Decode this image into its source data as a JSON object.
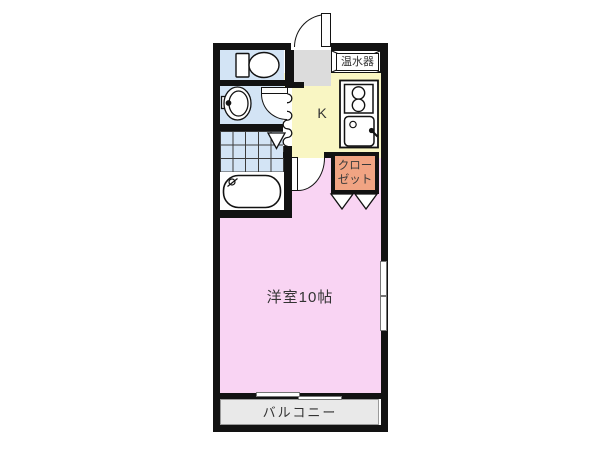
{
  "floorplan": {
    "title": "1K apartment floor plan",
    "labels": {
      "water_heater": "温水器",
      "kitchen": "K",
      "closet": "クロー\nゼット",
      "main_room": "洋室10帖",
      "balcony": "バルコニー"
    },
    "rooms": [
      {
        "name": "toilet",
        "color": "#d3e4f5"
      },
      {
        "name": "washroom",
        "color": "#d3e4f5"
      },
      {
        "name": "bathroom",
        "color": "#d3e4f5"
      },
      {
        "name": "entrance",
        "color": "#dcdcdc"
      },
      {
        "name": "kitchen",
        "label": "K",
        "color": "#f9f6c3"
      },
      {
        "name": "water-heater",
        "label": "温水器",
        "color": "#ffffff"
      },
      {
        "name": "closet",
        "label": "クローゼット",
        "color": "#f1a483"
      },
      {
        "name": "main-room",
        "label": "洋室10帖",
        "size_jo": 10,
        "color": "#f9d4f3"
      },
      {
        "name": "balcony",
        "label": "バルコニー",
        "color": "#e9e9e9"
      }
    ],
    "wall_color": "#121212"
  }
}
